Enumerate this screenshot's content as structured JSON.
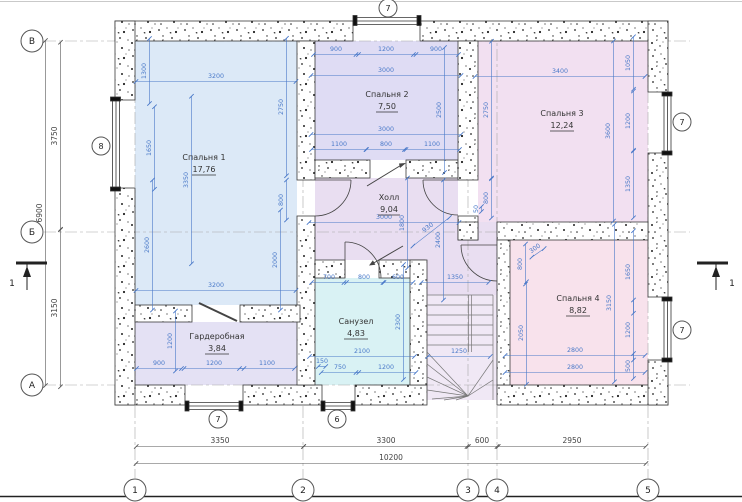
{
  "drawing": {
    "type_label": "floor-plan"
  },
  "colors": {
    "dim": "#4878c8",
    "outline": "#3a3a3a",
    "bedroom1": "#dce9f7",
    "bedroom2": "#dfdcf4",
    "bedroom3": "#f2e0f1",
    "bedroom4": "#f8e2ec",
    "hall": "#e9def1",
    "bathroom": "#d9f2f4",
    "wardrobe": "#e4e1f4",
    "stairs": "#f0e8f5"
  },
  "rooms": [
    {
      "name": "Спальня 1",
      "area": "17,76"
    },
    {
      "name": "Спальня 2",
      "area": "7,50"
    },
    {
      "name": "Спальня 3",
      "area": "12,24"
    },
    {
      "name": "Спальня 4",
      "area": "8,82"
    },
    {
      "name": "Холл",
      "area": "9,04"
    },
    {
      "name": "Санузел",
      "area": "4,83"
    },
    {
      "name": "Гардеробная",
      "area": "3,84"
    }
  ],
  "axes_v": [
    {
      "label": "1"
    },
    {
      "label": "2"
    },
    {
      "label": "3"
    },
    {
      "label": "4"
    },
    {
      "label": "5"
    }
  ],
  "axes_h": [
    {
      "label": "В"
    },
    {
      "label": "Б"
    },
    {
      "label": "А"
    }
  ],
  "markers": {
    "top": "7",
    "bottom_left": "7",
    "bottom_mid": "6",
    "left": "8",
    "right_top": "7",
    "right_bottom": "7"
  },
  "section_label": "1",
  "dims": [
    {
      "t": "1300",
      "x": 146,
      "y": 71,
      "r": -90
    },
    {
      "t": "3200",
      "x": 216,
      "y": 78,
      "r": 0
    },
    {
      "t": "1650",
      "x": 151,
      "y": 148,
      "r": -90
    },
    {
      "t": "3350",
      "x": 188,
      "y": 180,
      "r": -90
    },
    {
      "t": "2750",
      "x": 283,
      "y": 107,
      "r": -90
    },
    {
      "t": "800",
      "x": 283,
      "y": 200,
      "r": -90
    },
    {
      "t": "2600",
      "x": 149,
      "y": 245,
      "r": -90
    },
    {
      "t": "2000",
      "x": 277,
      "y": 260,
      "r": -90
    },
    {
      "t": "3200",
      "x": 216,
      "y": 287,
      "r": 0
    },
    {
      "t": "1200",
      "x": 172,
      "y": 341,
      "r": -90
    },
    {
      "t": "900",
      "x": 159,
      "y": 365,
      "r": 0
    },
    {
      "t": "1200",
      "x": 214,
      "y": 365,
      "r": 0
    },
    {
      "t": "1100",
      "x": 267,
      "y": 365,
      "r": 0
    },
    {
      "t": "900",
      "x": 336,
      "y": 51,
      "r": 0
    },
    {
      "t": "1200",
      "x": 386,
      "y": 51,
      "r": 0
    },
    {
      "t": "900",
      "x": 436,
      "y": 51,
      "r": 0
    },
    {
      "t": "3000",
      "x": 386,
      "y": 72,
      "r": 0
    },
    {
      "t": "2500",
      "x": 441,
      "y": 110,
      "r": -90
    },
    {
      "t": "3000",
      "x": 386,
      "y": 131,
      "r": 0
    },
    {
      "t": "1100",
      "x": 339,
      "y": 146,
      "r": 0
    },
    {
      "t": "800",
      "x": 386,
      "y": 146,
      "r": 0
    },
    {
      "t": "1100",
      "x": 432,
      "y": 146,
      "r": 0
    },
    {
      "t": "2750",
      "x": 488,
      "y": 110,
      "r": -90
    },
    {
      "t": "3400",
      "x": 560,
      "y": 73,
      "r": 0
    },
    {
      "t": "1050",
      "x": 630,
      "y": 63,
      "r": -90
    },
    {
      "t": "1200",
      "x": 630,
      "y": 121,
      "r": -90
    },
    {
      "t": "1350",
      "x": 630,
      "y": 184,
      "r": -90
    },
    {
      "t": "3600",
      "x": 610,
      "y": 131,
      "r": -90
    },
    {
      "t": "800",
      "x": 488,
      "y": 198,
      "r": -90
    },
    {
      "t": "50",
      "x": 478,
      "y": 209,
      "r": -90
    },
    {
      "t": "3000",
      "x": 384,
      "y": 219,
      "r": 0
    },
    {
      "t": "1800",
      "x": 404,
      "y": 223,
      "r": -90
    },
    {
      "t": "930",
      "x": 429,
      "y": 229,
      "r": -38
    },
    {
      "t": "2400",
      "x": 440,
      "y": 240,
      "r": -90
    },
    {
      "t": "700",
      "x": 329,
      "y": 279,
      "r": 0
    },
    {
      "t": "800",
      "x": 364,
      "y": 279,
      "r": 0
    },
    {
      "t": "600",
      "x": 398,
      "y": 279,
      "r": 0
    },
    {
      "t": "1350",
      "x": 455,
      "y": 279,
      "r": 0
    },
    {
      "t": "2300",
      "x": 400,
      "y": 322,
      "r": -90
    },
    {
      "t": "2100",
      "x": 362,
      "y": 353,
      "r": 0
    },
    {
      "t": "150",
      "x": 322,
      "y": 363,
      "r": 0
    },
    {
      "t": "750",
      "x": 340,
      "y": 369,
      "r": 0
    },
    {
      "t": "1200",
      "x": 386,
      "y": 369,
      "r": 0
    },
    {
      "t": "1250",
      "x": 459,
      "y": 353,
      "r": 0
    },
    {
      "t": "2050",
      "x": 523,
      "y": 333,
      "r": -90
    },
    {
      "t": "300",
      "x": 536,
      "y": 250,
      "r": -35
    },
    {
      "t": "800",
      "x": 522,
      "y": 264,
      "r": -90
    },
    {
      "t": "1650",
      "x": 630,
      "y": 272,
      "r": -90
    },
    {
      "t": "3150",
      "x": 611,
      "y": 303,
      "r": -90
    },
    {
      "t": "1200",
      "x": 630,
      "y": 330,
      "r": -90
    },
    {
      "t": "500",
      "x": 630,
      "y": 366,
      "r": -90
    },
    {
      "t": "2800",
      "x": 575,
      "y": 352,
      "r": 0
    },
    {
      "t": "2800",
      "x": 575,
      "y": 369,
      "r": 0
    },
    {
      "t": "3350",
      "x": 220,
      "y": 443,
      "r": 0,
      "c": "out"
    },
    {
      "t": "3300",
      "x": 386,
      "y": 443,
      "r": 0,
      "c": "out"
    },
    {
      "t": "600",
      "x": 482,
      "y": 443,
      "r": 0,
      "c": "out"
    },
    {
      "t": "2950",
      "x": 572,
      "y": 443,
      "r": 0,
      "c": "out"
    },
    {
      "t": "10200",
      "x": 391,
      "y": 460,
      "r": 0,
      "c": "out"
    },
    {
      "t": "3750",
      "x": 57,
      "y": 136,
      "r": -90,
      "c": "out"
    },
    {
      "t": "3150",
      "x": 57,
      "y": 308,
      "r": -90,
      "c": "out"
    },
    {
      "t": "6900",
      "x": 42,
      "y": 213,
      "r": -90,
      "c": "out"
    }
  ]
}
